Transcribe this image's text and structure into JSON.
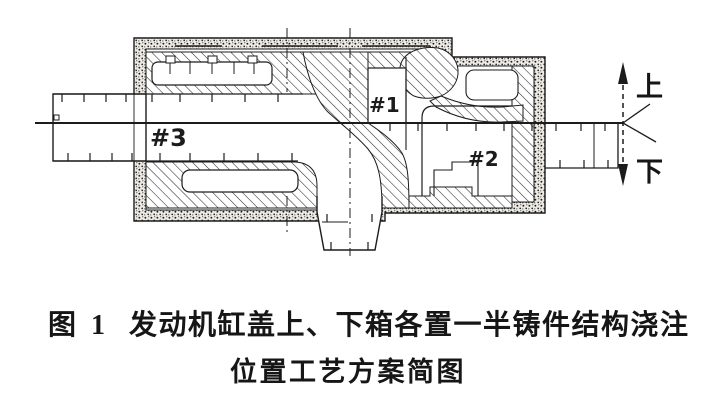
{
  "figure": {
    "number": "图 1",
    "caption_line1": "发动机缸盖上、下箱各置一半铸件结构浇注",
    "caption_line2": "位置工艺方案简图"
  },
  "drawing": {
    "region_labels": {
      "r1": "#1",
      "r2": "#2",
      "r3": "#3"
    },
    "orientation": {
      "up": "上",
      "down": "下"
    }
  },
  "colors": {
    "ink": "#1c1c1c",
    "paper": "#ffffff"
  }
}
